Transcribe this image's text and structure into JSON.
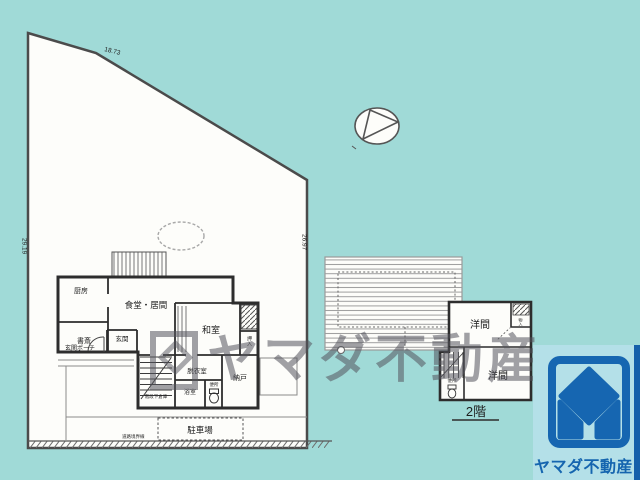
{
  "colors": {
    "background": "#a0dad7",
    "plan_paper": "#fdfdfa",
    "wall": "#2d2d2d",
    "logo_panel": "#b4e0e8",
    "navy_strip": "#1560aa",
    "logo_blue": "#1666b1"
  },
  "site": {
    "dim_top": "18.73",
    "dim_left": "29.19",
    "dim_right": "26.97",
    "road_boundary_label": "道路境界線"
  },
  "floor1": {
    "kitchen": "厨房",
    "dining_living": "食堂・居間",
    "study": "書斎",
    "entrance": "玄関",
    "entrance_porch": "玄関ポーチ",
    "japanese_room": "和室",
    "closet": "押入",
    "dressing_room": "脱衣室",
    "storeroom": "納戸",
    "bathroom": "浴室",
    "toilet": "便所",
    "under_stairs_storage": "階段下倉庫",
    "parking": "駐車場"
  },
  "floor2": {
    "western_room_upper": "洋間",
    "western_room_lower": "洋間",
    "toilet": "便所",
    "closet": "物入",
    "floor_label": "2階"
  },
  "watermark": {
    "text": "ヤマダ不動産"
  },
  "logo": {
    "company_name": "ヤマダ不動産"
  }
}
